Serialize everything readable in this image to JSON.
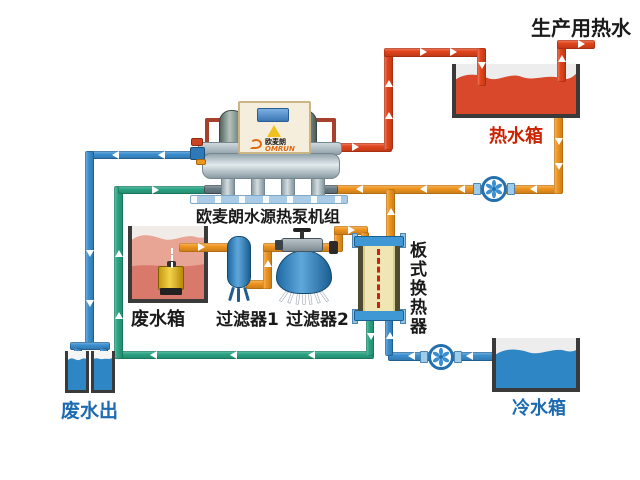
{
  "diagram_title": "生产用热水",
  "labels": {
    "production_hot_water": "生产用热水",
    "hot_water_tank": "热水箱",
    "heat_pump_unit": "欧麦朗水源热泵机组",
    "waste_water_tank": "废水箱",
    "filter_1": "过滤器1",
    "filter_2": "过滤器2",
    "plate_heat_exchanger": "板式换热器",
    "waste_water_out": "废水出",
    "cold_water_tank": "冷水箱"
  },
  "brand": {
    "cn": "欧麦朗",
    "en": "OMRUN"
  },
  "colors": {
    "hot_pipe": "#e2441c",
    "warm_pipe": "#f0951f",
    "cold_pipe": "#3b8fd0",
    "source_pipe": "#2aa584",
    "hot_water": "#d9482a",
    "cold_water": "#2e86c5",
    "waste_water": "#d8796c",
    "waste_water_light": "#e8a495",
    "label_red": "#cc2200",
    "label_blue": "#1d6ab0",
    "label_black": "#1a1a1a",
    "hx_body": "#f0e6b4",
    "pump_icon": "#3a8fd0"
  }
}
